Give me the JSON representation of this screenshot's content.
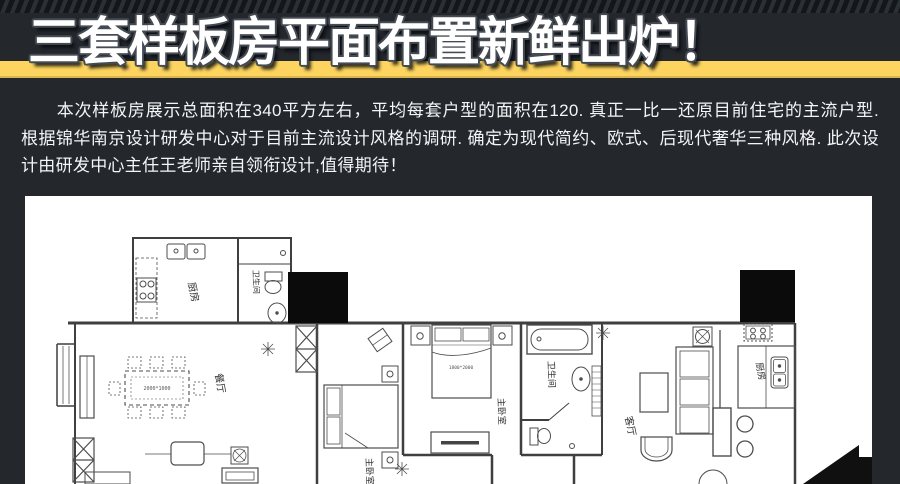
{
  "page": {
    "background_color": "#24282d",
    "accent_band_color": "#fcd45f",
    "panel_color": "#ffffff",
    "title_outline_color": "#454b53"
  },
  "header": {
    "title": "三套样板房平面布置新鲜出炉！"
  },
  "intro": {
    "paragraph": "本次样板房展示总面积在340平方左右，平均每套户型的面积在120. 真正一比一还原目前住宅的主流户型. 根据锦华南京设计研发中心对于目前主流设计风格的调研. 确定为现代简约、欧式、后现代奢华三种风格. 此次设计由研发中心主任王老师亲自领衔设计,值得期待！"
  },
  "floorplan": {
    "labels": {
      "kitchen_top": "厨房",
      "bath_top": "卫生间",
      "dining": "餐厅",
      "bedroom_left": "主卧室",
      "master_bedroom": "主卧室",
      "bath_main": "卫生间",
      "living": "客厅",
      "kitchen_right": "厨房",
      "dining_table_size": "2000*1000",
      "master_bed_size": "1800*2000"
    }
  }
}
